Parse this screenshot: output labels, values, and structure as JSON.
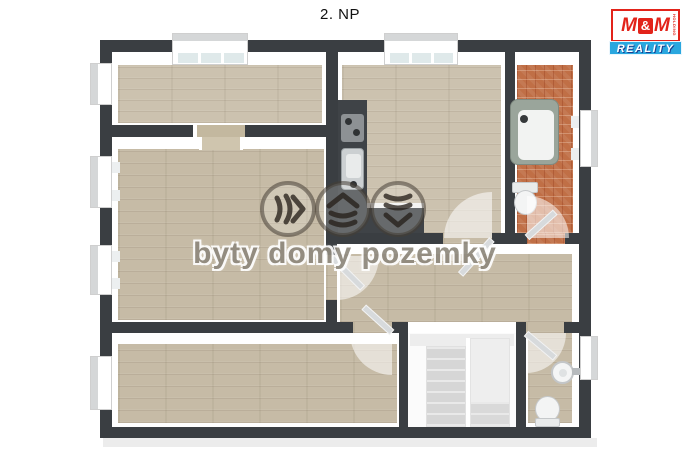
{
  "title": "2. NP",
  "watermark": {
    "text": "byty domy pozemky",
    "icons": [
      "chevrons-right-icon",
      "house-layers-icon",
      "waves-down-icon"
    ]
  },
  "logo": {
    "m_left": "M",
    "ampersand": "&",
    "m_right": "M",
    "holding": "HOLDING",
    "reality": "REALITY",
    "red": "#e2231a",
    "blue": "#2aa7df"
  },
  "floorplan": {
    "floor_label": "2. NP",
    "wall_color": "#3a3e42",
    "wood_floor_color": "#cbc1ae",
    "tile_floor_color": "#c06f46",
    "rooms": [
      {
        "id": "room-top-left",
        "floor": "wood",
        "windows": [
          "top-wall",
          "left-wall"
        ]
      },
      {
        "id": "kitchen",
        "floor": "wood",
        "windows": [
          "top-wall"
        ],
        "fixtures": [
          "counter",
          "sink",
          "cooktop"
        ]
      },
      {
        "id": "bathroom",
        "floor": "orange-tile",
        "windows": [
          "right-wall"
        ],
        "fixtures": [
          "bathtub",
          "toilet"
        ]
      },
      {
        "id": "living-room",
        "floor": "wood",
        "windows": [
          "left-wall",
          "left-wall"
        ]
      },
      {
        "id": "hallway",
        "floor": "wood"
      },
      {
        "id": "room-bottom",
        "floor": "wood",
        "windows": [
          "left-wall"
        ]
      },
      {
        "id": "staircase",
        "type": "double-flight-stairs"
      },
      {
        "id": "wc",
        "floor": "wood",
        "windows": [
          "right-wall"
        ],
        "fixtures": [
          "washbasin",
          "toilet"
        ]
      }
    ]
  }
}
